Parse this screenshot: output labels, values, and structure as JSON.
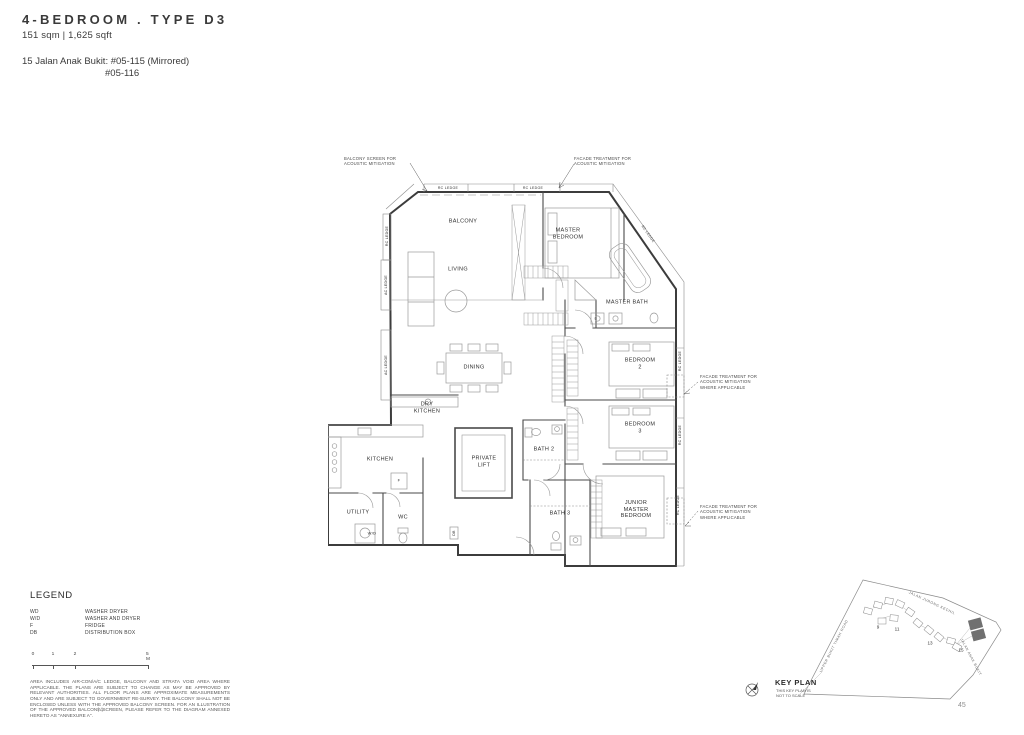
{
  "header": {
    "title": "4-BEDROOM . TYPE D3",
    "subtitle": "151 sqm | 1,625 sqft",
    "address_line1": "15 Jalan Anak Bukit: #05-115 (Mirrored)",
    "address_line2": "#05-116"
  },
  "plan": {
    "labels": [
      {
        "t": "BALCONY",
        "x": 135,
        "y": 74
      },
      {
        "t": "MASTER\nBEDROOM",
        "x": 240,
        "y": 86
      },
      {
        "t": "LIVING",
        "x": 130,
        "y": 122
      },
      {
        "t": "MASTER BATH",
        "x": 299,
        "y": 155
      },
      {
        "t": "DINING",
        "x": 146,
        "y": 220
      },
      {
        "t": "DRY\nKITCHEN",
        "x": 99,
        "y": 260
      },
      {
        "t": "KITCHEN",
        "x": 52,
        "y": 312
      },
      {
        "t": "UTILITY",
        "x": 30,
        "y": 365
      },
      {
        "t": "WC",
        "x": 75,
        "y": 370
      },
      {
        "t": "W/D",
        "x": 44,
        "y": 386,
        "fs": 4
      },
      {
        "t": "F",
        "x": 71,
        "y": 333,
        "fs": 4
      },
      {
        "t": "DB",
        "x": 126,
        "y": 385,
        "fs": 3.5,
        "rot": -90
      },
      {
        "t": "PRIVATE\nLIFT",
        "x": 156,
        "y": 314
      },
      {
        "t": "BATH 2",
        "x": 216,
        "y": 302
      },
      {
        "t": "BATH 3",
        "x": 232,
        "y": 366
      },
      {
        "t": "BEDROOM\n2",
        "x": 312,
        "y": 216
      },
      {
        "t": "BEDROOM\n3",
        "x": 312,
        "y": 280
      },
      {
        "t": "JUNIOR\nMASTER\nBEDROOM",
        "x": 308,
        "y": 362
      },
      {
        "t": "RC LEDGE",
        "x": 120,
        "y": 40,
        "fs": 3.5
      },
      {
        "t": "RC LEDGE",
        "x": 205,
        "y": 40,
        "fs": 3.5
      },
      {
        "t": "RC LEDGE",
        "x": 59,
        "y": 88,
        "fs": 3.5,
        "rot": -90
      },
      {
        "t": "RC LEDGE",
        "x": 320,
        "y": 86,
        "fs": 3.5,
        "rot": 55
      },
      {
        "t": "RC LEDGE",
        "x": 352,
        "y": 213,
        "fs": 3.5,
        "rot": -90
      },
      {
        "t": "RC LEDGE",
        "x": 352,
        "y": 287,
        "fs": 3.5,
        "rot": -90
      },
      {
        "t": "RC LEDGE",
        "x": 350,
        "y": 357,
        "fs": 3.5,
        "rot": -90
      },
      {
        "t": "AC LEDGE",
        "x": 58,
        "y": 137,
        "fs": 3.5,
        "rot": -90
      },
      {
        "t": "AC LEDGE",
        "x": 58,
        "y": 217,
        "fs": 3.5,
        "rot": -90
      }
    ],
    "annotations": [
      {
        "t": "BALCONY SCREEN FOR\nACOUSTIC MITIGATION",
        "x": 16,
        "y": 8,
        "w": 70
      },
      {
        "t": "FACADE TREATMENT FOR\nACOUSTIC MITIGATION",
        "x": 246,
        "y": 8,
        "w": 78
      },
      {
        "t": "FACADE TREATMENT FOR\nACOUSTIC MITIGATION\nWHERE APPLICABLE",
        "x": 372,
        "y": 226,
        "w": 62
      },
      {
        "t": "FACADE TREATMENT FOR\nACOUSTIC MITIGATION\nWHERE APPLICABLE",
        "x": 372,
        "y": 356,
        "w": 62
      }
    ]
  },
  "legend": {
    "heading": "LEGEND",
    "items": [
      {
        "abbr": "WD",
        "label": "WASHER DRYER"
      },
      {
        "abbr": "W/D",
        "label": "WASHER AND DRYER"
      },
      {
        "abbr": "F",
        "label": "FRIDGE"
      },
      {
        "abbr": "DB",
        "label": "DISTRIBUTION BOX"
      }
    ]
  },
  "scale_bar": {
    "ticks": [
      {
        "t": "0",
        "x": 3
      },
      {
        "t": "1",
        "x": 23
      },
      {
        "t": "2",
        "x": 45
      },
      {
        "t": "5 M",
        "x": 118
      }
    ]
  },
  "disclaimer": "AREA INCLUDES AIR-CON/A/C LEDGE, BALCONY AND STRATA VOID AREA WHERE APPLICABLE. THE PLANS ARE SUBJECT TO CHANGE AS MAY BE APPROVED BY RELEVANT AUTHORITIES. ALL FLOOR PLANS ARE APPROXIMATE MEASUREMENTS ONLY AND ARE SUBJECT TO GOVERNMENT RE-SURVEY. THE BALCONY SHALL NOT BE ENCLOSED UNLESS WITH THE APPROVED BALCONY SCREEN. FOR AN ILLUSTRATION OF THE APPROVED BALCONY SCREEN, PLEASE REFER TO THE DIAGRAM ANNEXED HERETO AS \"ANNEXURE A\".",
  "page_numbers": {
    "left": "44",
    "right": "45"
  },
  "key_plan": {
    "title": "KEY PLAN",
    "note": "THIS KEY PLAN IS\nNOT TO SCALE",
    "streets": [
      {
        "t": "JALAN JURONG KECHIL",
        "x": 194,
        "y": 25,
        "rot": 25
      },
      {
        "t": "UPPER BUKIT TIMAH ROAD",
        "x": 96,
        "y": 68,
        "rot": -63
      },
      {
        "t": "JALAN ANAK BUKIT",
        "x": 233,
        "y": 79,
        "rot": 62
      }
    ],
    "numbers": [
      {
        "t": "9",
        "x": 140,
        "y": 49
      },
      {
        "t": "11",
        "x": 159,
        "y": 51
      },
      {
        "t": "13",
        "x": 192,
        "y": 65
      },
      {
        "t": "15",
        "x": 223,
        "y": 72
      }
    ]
  }
}
